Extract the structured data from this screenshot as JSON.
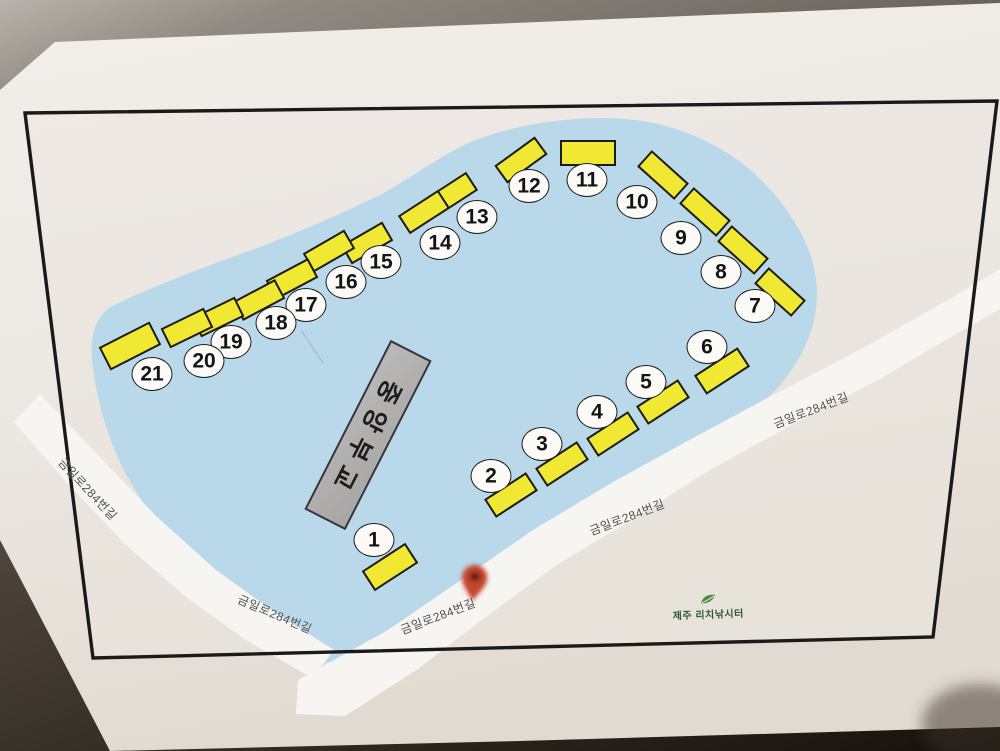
{
  "map": {
    "road_name": "금일로284번길",
    "road_name_occurrences": 5,
    "central_structure_label": "중앙부교",
    "facility_logo_text": "제주 리치낚시터",
    "site_numbers": [
      "1",
      "2",
      "3",
      "4",
      "5",
      "6",
      "7",
      "8",
      "9",
      "10",
      "11",
      "12",
      "13",
      "14",
      "15",
      "16",
      "17",
      "18",
      "19",
      "20",
      "21"
    ],
    "icons": {
      "location_pin": "map-pin",
      "logo_mark": "leaf"
    },
    "colors": {
      "pond_blue": "#b9d8ea",
      "site_yellow": "#f0e833",
      "pontoon_gray": "#b2b0ae",
      "pin_red": "#c2462e",
      "logo_green": "#2f5d31",
      "frame_black": "#1a1a1a",
      "road_white": "#f7f5f1",
      "paper": "#eeeae5"
    }
  }
}
